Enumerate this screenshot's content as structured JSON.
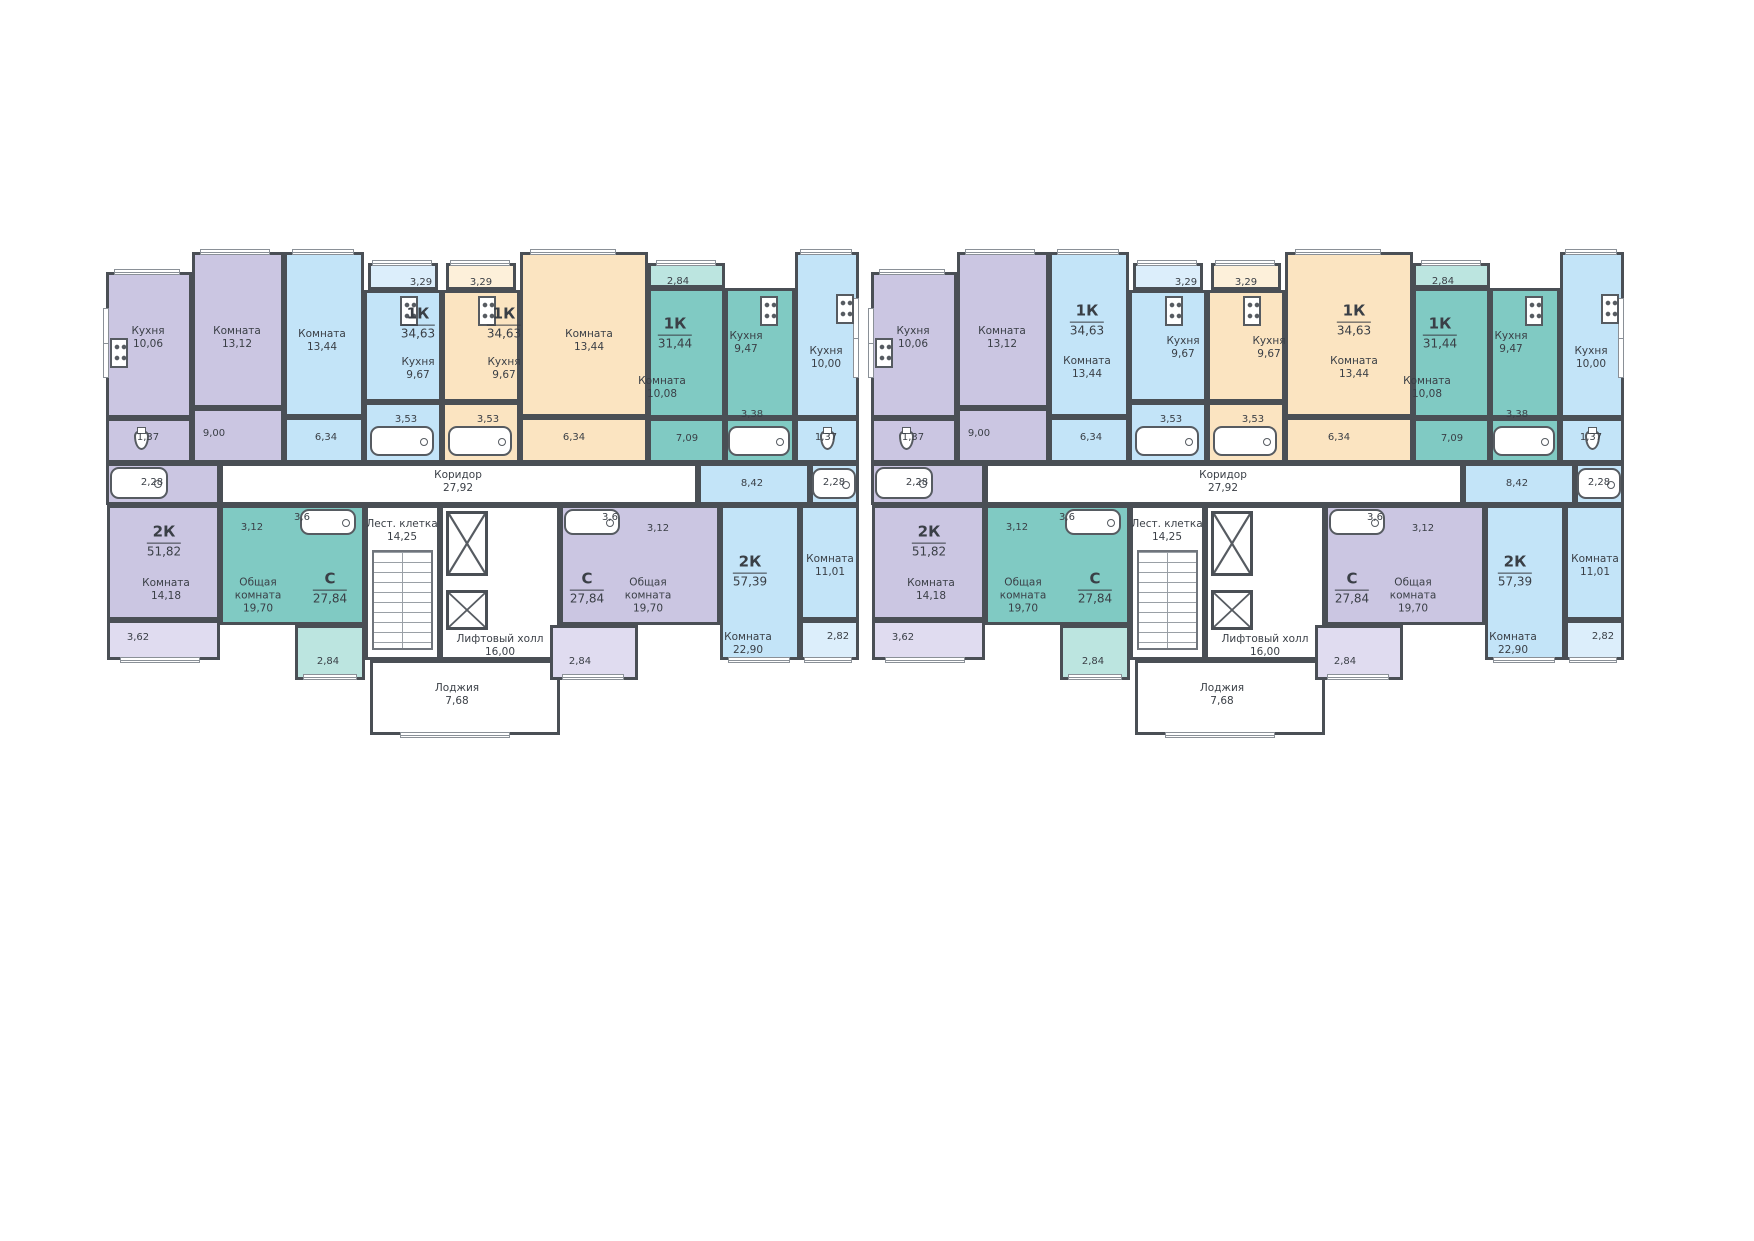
{
  "colors": {
    "wall": "#4a4f55",
    "text": "#3a3f46",
    "white": "#ffffff",
    "lavender": "#cbc6e2",
    "blue": "#c3e4f8",
    "beige": "#fbe4c1",
    "teal": "#80cac3",
    "lavLight": "#e0dcf0",
    "blueLight": "#dceefb",
    "tealLight": "#bce5e0",
    "beigeLight": "#fdf0da"
  },
  "plan": {
    "x": 100,
    "y": 238,
    "section_w": 765,
    "section_h": 510
  },
  "sections": [
    {
      "id": "section-1",
      "x": 0
    },
    {
      "id": "section-2",
      "x": 765
    }
  ],
  "zones": [
    {
      "id": "kitchen-10-06",
      "c": "lavender",
      "x": 6,
      "y": 34,
      "w": 86,
      "h": 146
    },
    {
      "id": "room-13-12",
      "c": "lavender",
      "x": 92,
      "y": 14,
      "w": 92,
      "h": 156
    },
    {
      "id": "room-13-44-blue",
      "c": "blue",
      "x": 184,
      "y": 14,
      "w": 80,
      "h": 165
    },
    {
      "id": "hall-6-34-blue",
      "c": "blue",
      "x": 184,
      "y": 179,
      "w": 80,
      "h": 46
    },
    {
      "id": "balcony-3-29-blue",
      "c": "blueLight",
      "x": 268,
      "y": 25,
      "w": 70,
      "h": 27
    },
    {
      "id": "kitchen-9-67-blue",
      "c": "blue",
      "x": 264,
      "y": 52,
      "w": 78,
      "h": 112
    },
    {
      "id": "bath-3-53-blue",
      "c": "blue",
      "x": 264,
      "y": 164,
      "w": 78,
      "h": 61
    },
    {
      "id": "balcony-3-29-beige",
      "c": "beigeLight",
      "x": 346,
      "y": 25,
      "w": 70,
      "h": 27
    },
    {
      "id": "kitchen-9-67-beige",
      "c": "beige",
      "x": 342,
      "y": 52,
      "w": 78,
      "h": 112
    },
    {
      "id": "bath-3-53-beige",
      "c": "beige",
      "x": 342,
      "y": 164,
      "w": 78,
      "h": 61
    },
    {
      "id": "room-13-44-beige",
      "c": "beige",
      "x": 420,
      "y": 14,
      "w": 128,
      "h": 165
    },
    {
      "id": "hall-6-34-beige",
      "c": "beige",
      "x": 420,
      "y": 179,
      "w": 128,
      "h": 46
    },
    {
      "id": "balcony-2-84-top",
      "c": "tealLight",
      "x": 548,
      "y": 25,
      "w": 77,
      "h": 25
    },
    {
      "id": "room-10-08-teal",
      "c": "teal",
      "x": 548,
      "y": 50,
      "w": 77,
      "h": 130
    },
    {
      "id": "hall-7-09-teal",
      "c": "teal",
      "x": 548,
      "y": 180,
      "w": 77,
      "h": 45
    },
    {
      "id": "kitchen-9-47-teal",
      "c": "teal",
      "x": 625,
      "y": 50,
      "w": 70,
      "h": 130
    },
    {
      "id": "bath-3-38-teal",
      "c": "teal",
      "x": 625,
      "y": 180,
      "w": 70,
      "h": 45
    },
    {
      "id": "kitchen-10-00",
      "c": "blue",
      "x": 695,
      "y": 14,
      "w": 64,
      "h": 166
    },
    {
      "id": "wc-1-37-right",
      "c": "blue",
      "x": 695,
      "y": 180,
      "w": 64,
      "h": 45
    },
    {
      "id": "wc-1-37-left",
      "c": "lavender",
      "x": 6,
      "y": 180,
      "w": 86,
      "h": 45
    },
    {
      "id": "hall-9-00",
      "c": "lavender",
      "x": 92,
      "y": 170,
      "w": 92,
      "h": 55
    },
    {
      "id": "bath-2-28-left",
      "c": "lavender",
      "x": 6,
      "y": 225,
      "w": 114,
      "h": 42
    },
    {
      "id": "corridor",
      "c": "white",
      "x": 120,
      "y": 225,
      "w": 478,
      "h": 42
    },
    {
      "id": "hall-8-42",
      "c": "blue",
      "x": 598,
      "y": 225,
      "w": 112,
      "h": 42
    },
    {
      "id": "bath-2-28-right",
      "c": "blue",
      "x": 710,
      "y": 225,
      "w": 49,
      "h": 42
    },
    {
      "id": "room-14-18",
      "c": "lavender",
      "x": 7,
      "y": 267,
      "w": 113,
      "h": 115
    },
    {
      "id": "balcony-3-62",
      "c": "lavLight",
      "x": 7,
      "y": 382,
      "w": 113,
      "h": 40
    },
    {
      "id": "studio-19-70-left",
      "c": "teal",
      "x": 120,
      "y": 267,
      "w": 145,
      "h": 120
    },
    {
      "id": "balcony-2-84-left",
      "c": "tealLight",
      "x": 195,
      "y": 387,
      "w": 70,
      "h": 55
    },
    {
      "id": "stairwell",
      "c": "white",
      "x": 265,
      "y": 267,
      "w": 75,
      "h": 155
    },
    {
      "id": "elevator-hall",
      "c": "white",
      "x": 340,
      "y": 267,
      "w": 120,
      "h": 155
    },
    {
      "id": "loggia",
      "c": "white",
      "x": 270,
      "y": 422,
      "w": 190,
      "h": 75
    },
    {
      "id": "studio-19-70-right",
      "c": "lavender",
      "x": 460,
      "y": 267,
      "w": 160,
      "h": 120
    },
    {
      "id": "balcony-2-84-right",
      "c": "lavLight",
      "x": 450,
      "y": 387,
      "w": 88,
      "h": 55
    },
    {
      "id": "room-22-90",
      "c": "blue",
      "x": 620,
      "y": 267,
      "w": 80,
      "h": 155
    },
    {
      "id": "room-11-01",
      "c": "blue",
      "x": 700,
      "y": 267,
      "w": 59,
      "h": 115
    },
    {
      "id": "balcony-2-82",
      "c": "blueLight",
      "x": 700,
      "y": 382,
      "w": 59,
      "h": 40
    }
  ],
  "features": [
    {
      "type": "stairs",
      "id": "stair-flight",
      "x": 272,
      "y": 312,
      "w": 61,
      "h": 100
    },
    {
      "type": "shaft",
      "id": "elevator-shaft-1",
      "x": 346,
      "y": 273,
      "w": 42,
      "h": 65
    },
    {
      "type": "shaft",
      "id": "elevator-shaft-2",
      "x": 346,
      "y": 352,
      "w": 42,
      "h": 40
    }
  ],
  "windows": [
    {
      "x": 14,
      "y": 31,
      "w": 66,
      "h": 6
    },
    {
      "x": 100,
      "y": 11,
      "w": 70,
      "h": 6
    },
    {
      "x": 192,
      "y": 11,
      "w": 62,
      "h": 6
    },
    {
      "x": 272,
      "y": 22,
      "w": 60,
      "h": 6
    },
    {
      "x": 350,
      "y": 22,
      "w": 60,
      "h": 6
    },
    {
      "x": 430,
      "y": 11,
      "w": 86,
      "h": 6
    },
    {
      "x": 556,
      "y": 22,
      "w": 60,
      "h": 6
    },
    {
      "x": 700,
      "y": 11,
      "w": 52,
      "h": 6
    },
    {
      "x": 20,
      "y": 419,
      "w": 80,
      "h": 6
    },
    {
      "x": 203,
      "y": 436,
      "w": 54,
      "h": 6
    },
    {
      "x": 300,
      "y": 494,
      "w": 110,
      "h": 6
    },
    {
      "x": 462,
      "y": 436,
      "w": 62,
      "h": 6
    },
    {
      "x": 628,
      "y": 419,
      "w": 62,
      "h": 6
    },
    {
      "x": 704,
      "y": 419,
      "w": 48,
      "h": 6
    },
    {
      "x": 3,
      "y": 70,
      "w": 6,
      "h": 70
    },
    {
      "x": 753,
      "y": 60,
      "w": 6,
      "h": 80
    }
  ],
  "fixtures": [
    {
      "type": "stove",
      "x": 10,
      "y": 100
    },
    {
      "type": "stove",
      "x": 300,
      "y": 58
    },
    {
      "type": "stove",
      "x": 378,
      "y": 58
    },
    {
      "type": "stove",
      "x": 660,
      "y": 58
    },
    {
      "type": "stove",
      "x": 736,
      "y": 56
    },
    {
      "type": "tub",
      "x": 270,
      "y": 188,
      "w": 64,
      "h": 30
    },
    {
      "type": "tub",
      "x": 348,
      "y": 188,
      "w": 64,
      "h": 30
    },
    {
      "type": "tub",
      "x": 628,
      "y": 188,
      "w": 62,
      "h": 30
    },
    {
      "type": "tub",
      "x": 10,
      "y": 229,
      "w": 58,
      "h": 32
    },
    {
      "type": "tub",
      "x": 712,
      "y": 230,
      "w": 44,
      "h": 31
    },
    {
      "type": "tub",
      "x": 200,
      "y": 271,
      "w": 56,
      "h": 26
    },
    {
      "type": "tub",
      "x": 464,
      "y": 271,
      "w": 56,
      "h": 26
    },
    {
      "type": "wc",
      "x": 34,
      "y": 192
    },
    {
      "type": "wc",
      "x": 720,
      "y": 192
    }
  ],
  "labels_shared": [
    {
      "t": "Кухня\n10,06",
      "x": 48,
      "y": 100,
      "k": "r"
    },
    {
      "t": "Комната\n13,12",
      "x": 137,
      "y": 100,
      "k": "r"
    },
    {
      "t": "3,29",
      "x": 321,
      "y": 45,
      "k": "s"
    },
    {
      "t": "3,29",
      "x": 381,
      "y": 45,
      "k": "s"
    },
    {
      "t": "3,53",
      "x": 306,
      "y": 182,
      "k": "s"
    },
    {
      "t": "3,53",
      "x": 388,
      "y": 182,
      "k": "s"
    },
    {
      "t": "6,34",
      "x": 226,
      "y": 200,
      "k": "s"
    },
    {
      "t": "6,34",
      "x": 474,
      "y": 200,
      "k": "s"
    },
    {
      "t": "2,84",
      "x": 578,
      "y": 44,
      "k": "s"
    },
    {
      "t": "1К|31,44",
      "x": 575,
      "y": 95,
      "k": "a"
    },
    {
      "t": "Комната\n10,08",
      "x": 562,
      "y": 150,
      "k": "r"
    },
    {
      "t": "Кухня\n9,47",
      "x": 646,
      "y": 105,
      "k": "r"
    },
    {
      "t": "7,09",
      "x": 587,
      "y": 201,
      "k": "s"
    },
    {
      "t": "3,38",
      "x": 652,
      "y": 177,
      "k": "s"
    },
    {
      "t": "Кухня\n10,00",
      "x": 726,
      "y": 120,
      "k": "r"
    },
    {
      "t": "1,37",
      "x": 726,
      "y": 200,
      "k": "s"
    },
    {
      "t": "9,00",
      "x": 114,
      "y": 196,
      "k": "s"
    },
    {
      "t": "1,37",
      "x": 48,
      "y": 200,
      "k": "s"
    },
    {
      "t": "2,28",
      "x": 52,
      "y": 245,
      "k": "s"
    },
    {
      "t": "Коридор\n27,92",
      "x": 358,
      "y": 244,
      "k": "r"
    },
    {
      "t": "8,42",
      "x": 652,
      "y": 246,
      "k": "s"
    },
    {
      "t": "2,28",
      "x": 734,
      "y": 245,
      "k": "s"
    },
    {
      "t": "2К|51,82",
      "x": 64,
      "y": 303,
      "k": "a"
    },
    {
      "t": "Комната\n14,18",
      "x": 66,
      "y": 352,
      "k": "r"
    },
    {
      "t": "3,62",
      "x": 38,
      "y": 400,
      "k": "s"
    },
    {
      "t": "3,12",
      "x": 152,
      "y": 290,
      "k": "s"
    },
    {
      "t": "3,6",
      "x": 202,
      "y": 280,
      "k": "s"
    },
    {
      "t": "Общая\nкомната\n19,70",
      "x": 158,
      "y": 358,
      "k": "r"
    },
    {
      "t": "С|27,84",
      "x": 230,
      "y": 350,
      "k": "a"
    },
    {
      "t": "2,84",
      "x": 228,
      "y": 424,
      "k": "s"
    },
    {
      "t": "Лест. клетка\n14,25",
      "x": 302,
      "y": 293,
      "k": "r"
    },
    {
      "t": "Лифтовый холл\n16,00",
      "x": 400,
      "y": 408,
      "k": "r"
    },
    {
      "t": "3,6",
      "x": 510,
      "y": 280,
      "k": "s"
    },
    {
      "t": "3,12",
      "x": 558,
      "y": 291,
      "k": "s"
    },
    {
      "t": "С|27,84",
      "x": 487,
      "y": 350,
      "k": "a"
    },
    {
      "t": "Общая\nкомната\n19,70",
      "x": 548,
      "y": 358,
      "k": "r"
    },
    {
      "t": "2,84",
      "x": 480,
      "y": 424,
      "k": "s"
    },
    {
      "t": "2К|57,39",
      "x": 650,
      "y": 333,
      "k": "a"
    },
    {
      "t": "Комната\n22,90",
      "x": 648,
      "y": 406,
      "k": "r"
    },
    {
      "t": "Комната\n11,01",
      "x": 730,
      "y": 328,
      "k": "r"
    },
    {
      "t": "2,82",
      "x": 738,
      "y": 399,
      "k": "s"
    },
    {
      "t": "Лоджия\n7,68",
      "x": 357,
      "y": 457,
      "k": "r"
    }
  ],
  "labels_section_1": [
    {
      "t": "Комната\n13,44",
      "x": 222,
      "y": 103,
      "k": "r"
    },
    {
      "t": "1К|34,63",
      "x": 318,
      "y": 85,
      "k": "a"
    },
    {
      "t": "Кухня\n9,67",
      "x": 318,
      "y": 131,
      "k": "r"
    },
    {
      "t": "1К|34,63",
      "x": 404,
      "y": 85,
      "k": "a"
    },
    {
      "t": "Кухня\n9,67",
      "x": 404,
      "y": 131,
      "k": "r"
    },
    {
      "t": "Комната\n13,44",
      "x": 489,
      "y": 103,
      "k": "r"
    }
  ],
  "labels_section_2": [
    {
      "t": "1К|34,63",
      "x": 222,
      "y": 82,
      "k": "a"
    },
    {
      "t": "Комната\n13,44",
      "x": 222,
      "y": 130,
      "k": "r"
    },
    {
      "t": "Кухня\n9,67",
      "x": 318,
      "y": 110,
      "k": "r"
    },
    {
      "t": "Кухня\n9,67",
      "x": 404,
      "y": 110,
      "k": "r"
    },
    {
      "t": "1К|34,63",
      "x": 489,
      "y": 82,
      "k": "a"
    },
    {
      "t": "Комната\n13,44",
      "x": 489,
      "y": 130,
      "k": "r"
    }
  ]
}
